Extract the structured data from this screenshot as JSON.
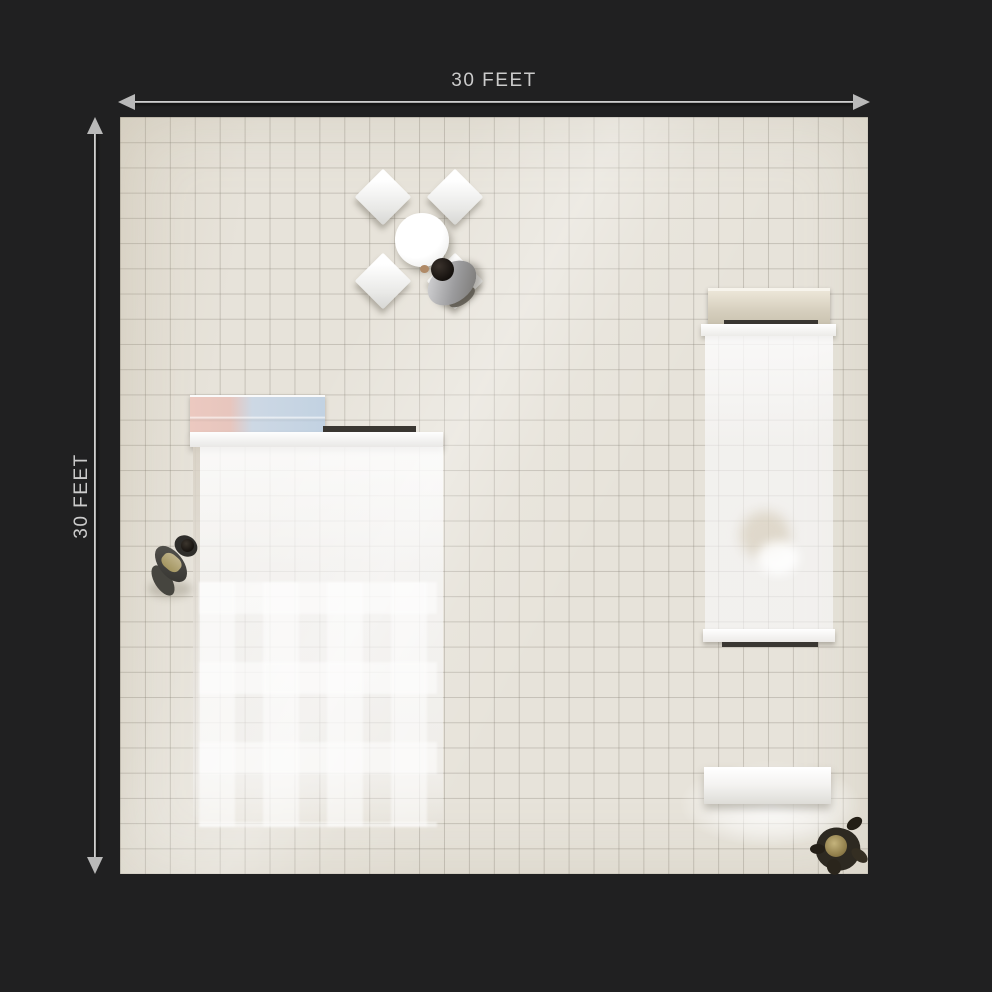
{
  "dimensions": {
    "top": {
      "label": "30 FEET"
    },
    "left": {
      "label": "30 FEET"
    }
  },
  "colors": {
    "background": "#202021",
    "floor": "#e7e3da",
    "grid_line": "rgba(110,104,92,0.33)",
    "dimension_text": "#cbcbcb",
    "header_pink": "#ecc9c0",
    "header_blue": "#c2d2e2",
    "canopy_beige": "#d7d0bf",
    "dark_strip": "#3a3732"
  }
}
